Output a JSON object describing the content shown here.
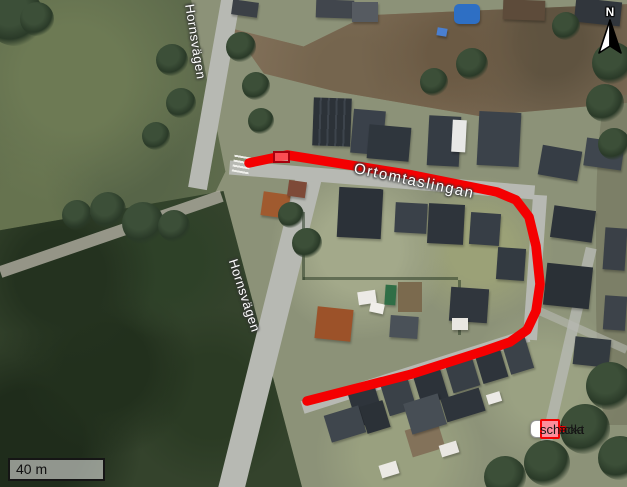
{
  "map": {
    "road_labels": [
      {
        "id": "hornsvagen-north",
        "text": "Hornsvägen"
      },
      {
        "id": "hornsvagen-south",
        "text": "Hornsvägen"
      },
      {
        "id": "ortomtaslingan",
        "text": "Ortomtaslingan"
      }
    ],
    "north_arrow": {
      "label": "N"
    },
    "scale_bar": {
      "label": "40 m"
    },
    "route": {
      "name": "Sträcka",
      "color": "#f40001",
      "stroke_width": "9.5",
      "points": "249,163 287,155 412,175 497,192 516,200 529,217 536,246 540,284 536,311 527,330 510,342 484,351 412,374 307,401"
    },
    "schackt_marker": {
      "name": "schackt",
      "fill": "#ff8c98",
      "border": "#a8000e"
    }
  },
  "legend": {
    "items": [
      {
        "label": "Sträcka",
        "symbol": "route-line-icon",
        "color": "#f40001"
      },
      {
        "label": "schackt",
        "symbol": "pink-square-icon",
        "fill": "#fd8e9c",
        "border": "#f40001"
      }
    ]
  }
}
